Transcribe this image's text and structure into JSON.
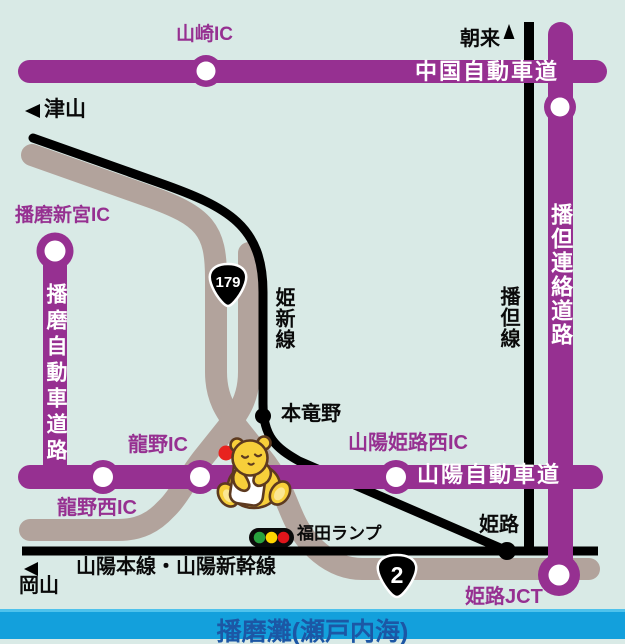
{
  "sea": {
    "label": "播磨灘(瀬戸内海)"
  },
  "expressways": {
    "chugoku": "中国自動車道",
    "sanyo": "山陽自動車道",
    "harima": "播磨自動車道路",
    "bantan_renraku": "播但連絡道路"
  },
  "railways": {
    "kishin": "姫新線",
    "bantan": "播但線",
    "sanyo_main": "山陽本線・山陽新幹線"
  },
  "interchanges": {
    "yamazaki": "山崎IC",
    "harima_shingu": "播磨新宮IC",
    "tatsuno": "龍野IC",
    "tatsuno_nishi": "龍野西IC",
    "sanyo_himeji_nishi": "山陽姫路西IC",
    "himeji_jct": "姫路JCT"
  },
  "stations": {
    "hontatsuno": "本竜野",
    "himeji": "姫路"
  },
  "ramp": {
    "fukuda": "福田ランプ"
  },
  "directions": {
    "asago": "朝来",
    "tsuyama": "津山",
    "okayama": "岡山"
  },
  "routes": {
    "r179": "179",
    "r2": "2"
  },
  "colors": {
    "background_mint": "#d9eae6",
    "expressway_purple": "#963091",
    "road_gray": "#b2a39c",
    "rail_black": "#000000",
    "sea_bar_blue": "#13a0dc",
    "sea_text_blue": "#1c57a5",
    "marker_red": "#e8231f",
    "signal_green": "#28a13e",
    "signal_yellow": "#ffd500",
    "signal_red": "#e0151b",
    "mascot_yellow": "#f7cf3a",
    "mascot_outline_brown": "#5d3a1f"
  }
}
